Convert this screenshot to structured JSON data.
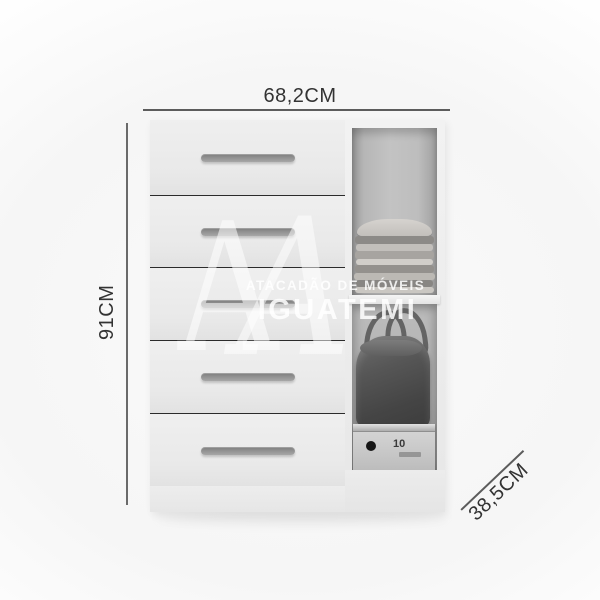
{
  "dimensions": {
    "width_label": "68,2CM",
    "height_label": "91CM",
    "depth_label": "38,5CM"
  },
  "watermark": {
    "monogram_a": "A",
    "line1": "ATACADÃO DE MÓVEIS",
    "line2": "IGUATEMI"
  },
  "furniture": {
    "description": "5-drawer chest with open side compartments",
    "drawer_count": 5,
    "box_label": "10"
  },
  "colors": {
    "dimension_text": "#333333",
    "dimension_line": "#5c5c5c",
    "cabinet_face": "#ebebeb",
    "drawer_handle": "#909090",
    "compartment_interior": "#b6b6b6",
    "bag": "#4a4a4a",
    "shoe_box": "#c8c8c8"
  }
}
